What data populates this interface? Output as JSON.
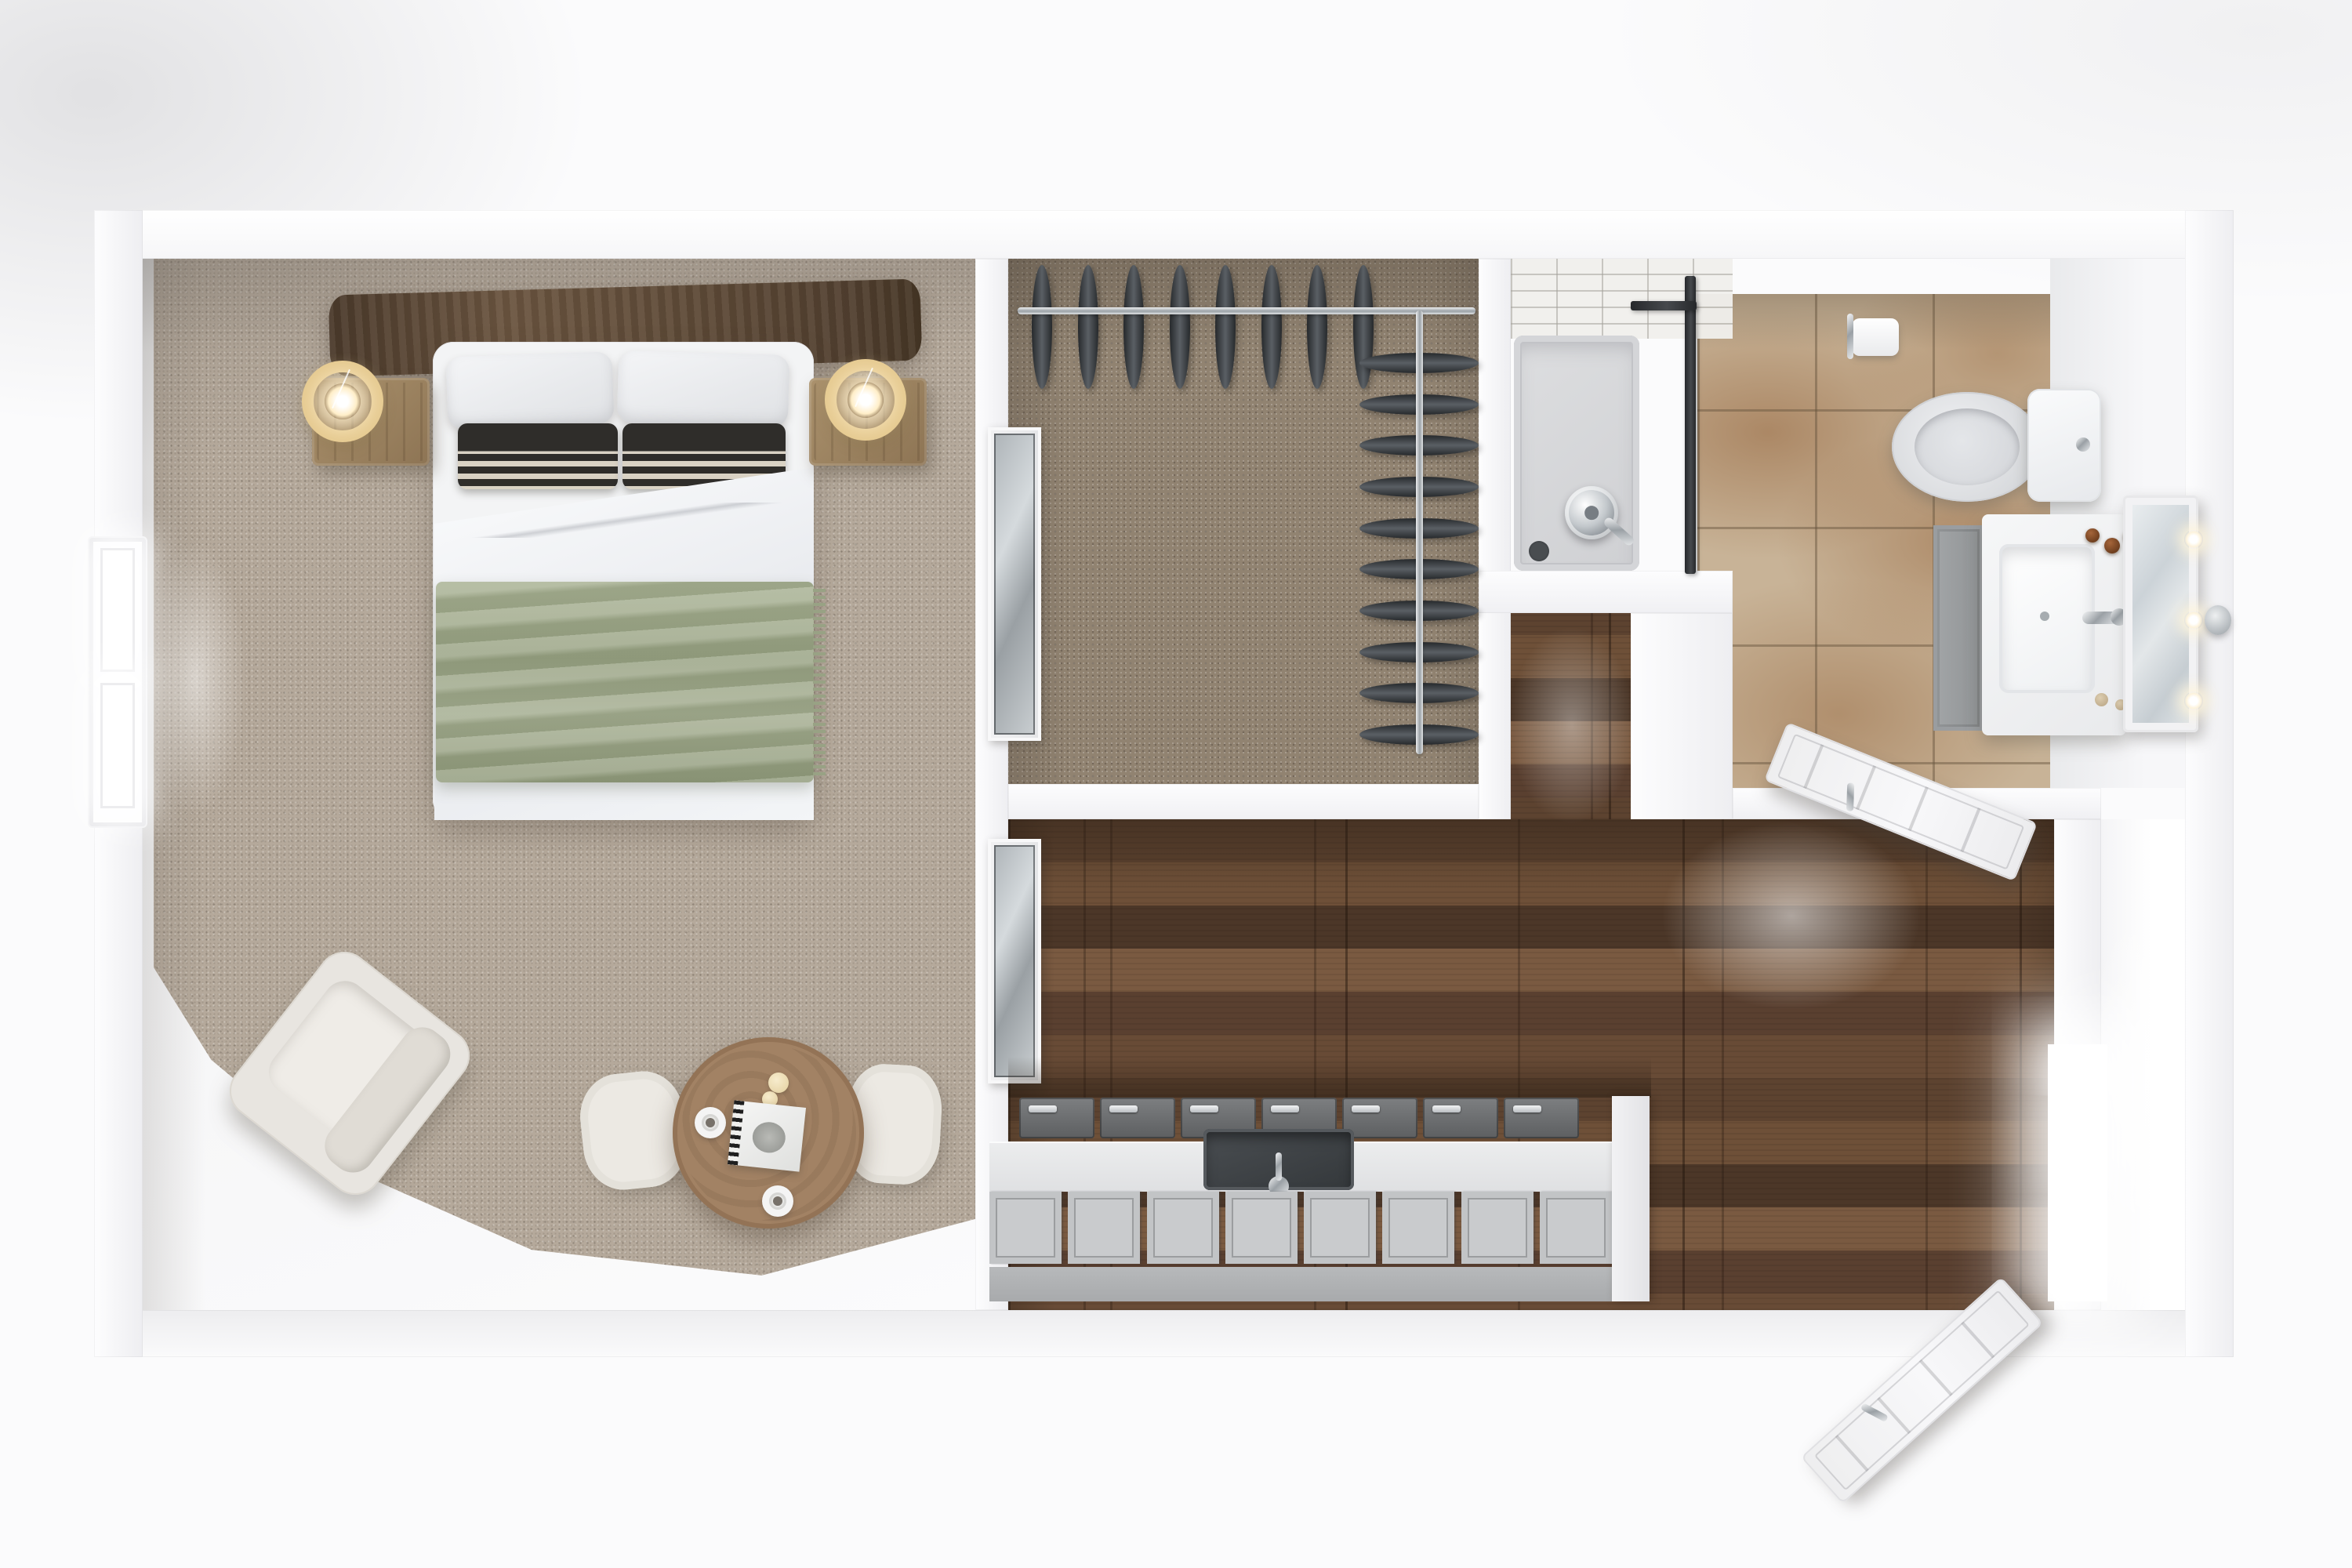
{
  "scene": {
    "title": "Top-down 3D rendered floor plan of a studio apartment",
    "render_style": "photorealistic dollhouse view, no text labels visible"
  },
  "colors": {
    "page": "#fbfbfc",
    "wall": "#f7f7f8",
    "wall-face": "#e9e9ec",
    "carpet": "#b5a99b",
    "closet-carpet": "#918371",
    "tile": "#c8b397",
    "wood-dark": "#4c3728",
    "wood-mid": "#6e5038",
    "wood-light": "#7a5a41",
    "shower-pan": "#d8d9db",
    "glass-frame": "#2c2e31",
    "lamp-gold": "#e5c98f",
    "blanket-green": "#a4ad90",
    "headboard-brown": "#5e4a37",
    "seating-cream": "#e9e6e1",
    "counter-grey": "#c9cbcd",
    "appliance-dark": "#5f6163",
    "sink-dark": "#3c4043",
    "garment-dark": "#33363a",
    "chrome": "#c6cacd",
    "bottle-brown": "#7a4a28"
  },
  "rooms": {
    "bedroom": {
      "name": "Bedroom with area carpet"
    },
    "closet": {
      "name": "Walk-in closet"
    },
    "bathroom": {
      "name": "Bathroom"
    },
    "kitchen": {
      "name": "Kitchen and hallway with hardwood floor"
    },
    "entry": {
      "name": "Entry vestibule"
    }
  },
  "furniture": {
    "bedroom": [
      "double bed with dark wood headboard",
      "two white pillows",
      "two black-and-white striped pillows",
      "white duvet",
      "sage green throw blanket",
      "two wooden nightstands",
      "two glowing ring lamps",
      "white armchair",
      "round wooden table",
      "two cream chairs",
      "two coffee cups",
      "magazine",
      "two candles",
      "double-hung window"
    ],
    "closet": {
      "items": [
        "chrome hanging rail back",
        "chrome hanging rail side",
        "sliding mirror door panel"
      ],
      "rail_back_garments": 8,
      "rail_side_garments": 10
    },
    "bathroom": [
      "walk-in shower with glass screen",
      "chrome shower head",
      "floor drain",
      "white subway tile wall",
      "toilet with grey seat",
      "toilet paper holder",
      "grey vanity cabinet",
      "white sink counter",
      "chrome faucet",
      "amber bottles",
      "leaning hollywood mirror",
      "wall sconce"
    ],
    "bathroom_mirror_bulbs": 3,
    "kitchen": {
      "items": [
        "one-wall kitchen counter",
        "undermount dark sink",
        "chrome faucet",
        "cabinet plinth",
        "end panel"
      ],
      "upper_row_panels": 7,
      "door_panels": 8
    },
    "hall": [
      "open bathroom door",
      "open entry door",
      "sliding panel on hall side"
    ]
  }
}
